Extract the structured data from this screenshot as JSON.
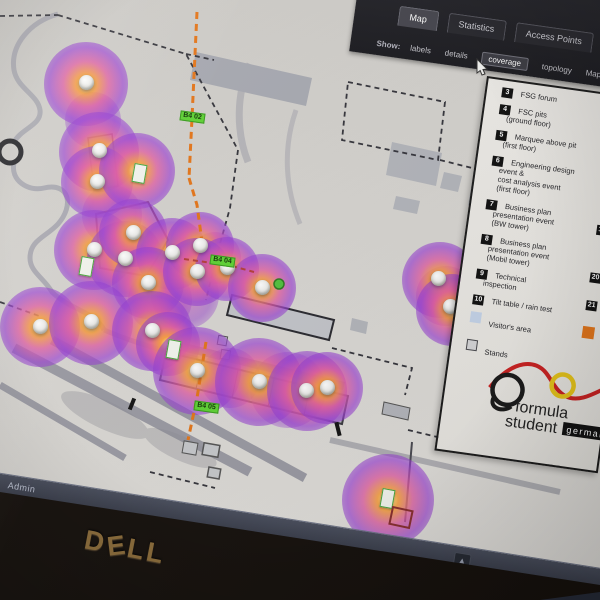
{
  "device": {
    "brand_logo": "DELL"
  },
  "status_bar": {
    "user_label": "Admin",
    "scroll_up_icon": "▲"
  },
  "toolbar": {
    "tabs": [
      {
        "label": "Map",
        "active": true
      },
      {
        "label": "Statistics",
        "active": false
      },
      {
        "label": "Access Points",
        "active": false
      }
    ],
    "show_label": "Show:",
    "show_options": [
      {
        "label": "labels",
        "active": false
      },
      {
        "label": "details",
        "active": false
      },
      {
        "label": "coverage",
        "active": true
      },
      {
        "label": "topology",
        "active": false
      },
      {
        "label": "Maps",
        "active": false
      }
    ]
  },
  "map": {
    "waypoint_labels": [
      "B4 02",
      "B4 04",
      "B4 05"
    ],
    "colors": {
      "heat_core": "#ffd24d",
      "heat_mid": "#e05aa0",
      "heat_edge": "#8a3cd0",
      "route": "#e5761a",
      "waypoint_bg": "#5fd435"
    }
  },
  "legend": {
    "items": [
      {
        "num": "3",
        "lines": [
          "FSG forum"
        ]
      },
      {
        "num": "4",
        "lines": [
          "FSC pits",
          "(ground floor)"
        ]
      },
      {
        "num": "5",
        "lines": [
          "Marquee above pit",
          "(first floor)"
        ]
      },
      {
        "num": "6",
        "lines": [
          "Engineering design",
          "event &",
          "cost analysis event",
          "(first floor)"
        ]
      },
      {
        "num": "7",
        "lines": [
          "Business plan",
          "presentation event",
          "(BW tower)"
        ]
      },
      {
        "num": "8",
        "lines": [
          "Business plan",
          "presentation event",
          "(Mobil tower)"
        ]
      },
      {
        "num": "9",
        "lines": [
          "Technical",
          "inspection"
        ]
      },
      {
        "num": "10",
        "lines": [
          "Tilt table / rain test"
        ]
      }
    ],
    "swatches": [
      {
        "label": "Visitor's area",
        "color": "#c6d5ea",
        "border": ""
      },
      {
        "label": "Stands",
        "color": "#d6d6d8",
        "border": "#4a4a4e"
      }
    ],
    "partial_column": {
      "badges": [
        "19",
        "20",
        "21"
      ],
      "swatch_color": "#e5761a"
    }
  },
  "logo": {
    "word1": "formula",
    "word2": "student",
    "badge": "germany"
  }
}
